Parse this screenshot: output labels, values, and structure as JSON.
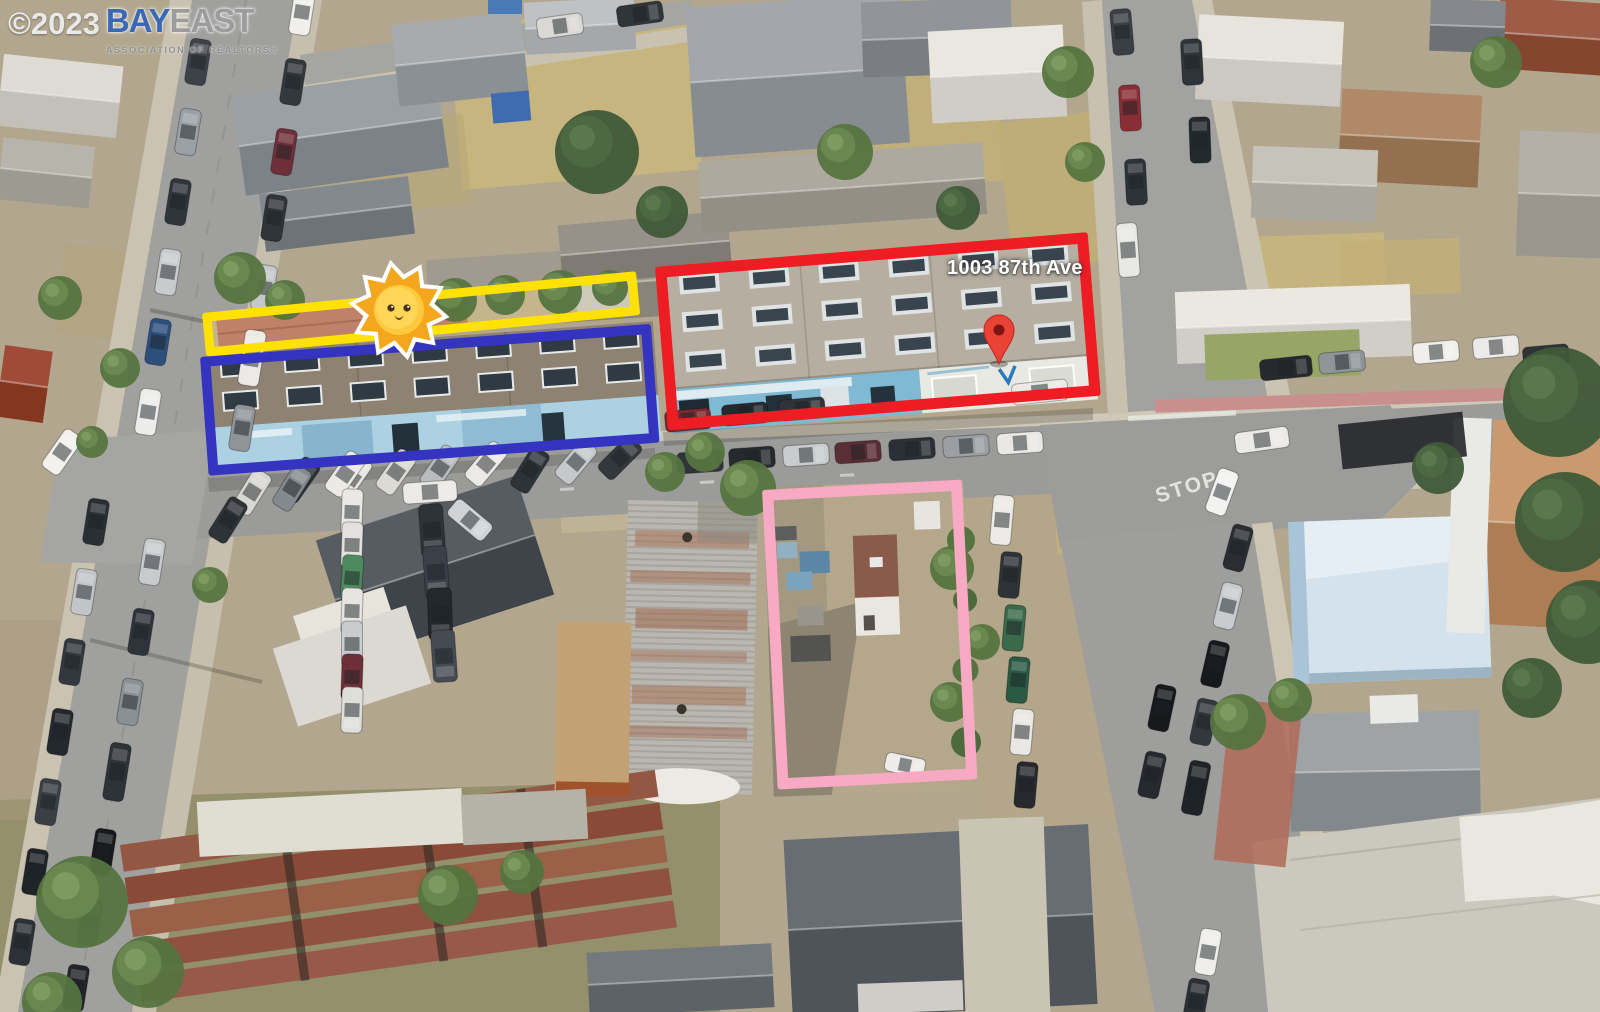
{
  "watermark": {
    "copyright": "©2023",
    "brand_primary": "BAY",
    "brand_secondary": "EAST",
    "tagline": "ASSOCIATION OF REALTORS®"
  },
  "map_label": {
    "address": "1003 87th Ave"
  },
  "road_markings": {
    "stop": "STOP"
  },
  "annotations": {
    "red_outline_color": "#ee1c23",
    "blue_outline_color": "#3434c0",
    "yellow_outline_color": "#ffe203",
    "pink_outline_color": "#f8a9c3",
    "map_pin_color": "#ea4335"
  },
  "icons": {
    "sun_sticker": "sun-face-sticker",
    "map_pin": "map-pin-icon"
  }
}
